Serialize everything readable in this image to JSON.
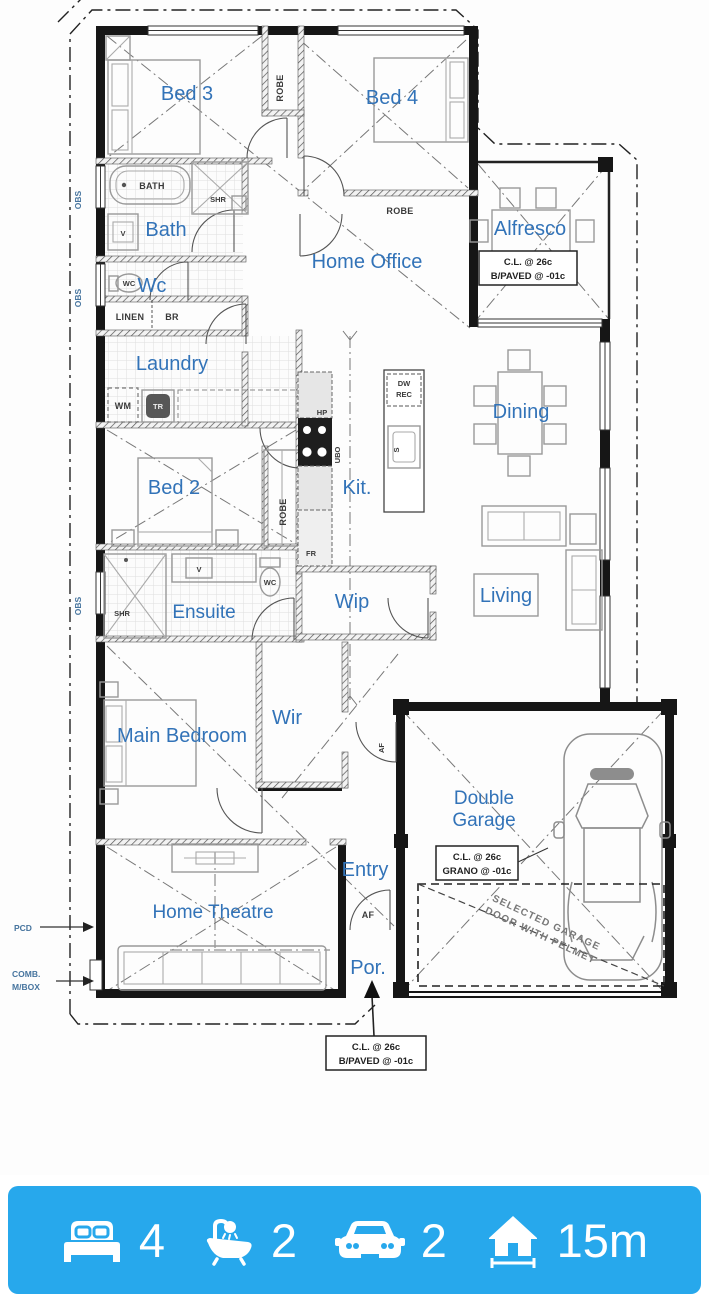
{
  "plan": {
    "rooms": {
      "bed3": "Bed 3",
      "bed4": "Bed 4",
      "bath": "Bath",
      "wc": "Wc",
      "laundry": "Laundry",
      "home_office": "Home Office",
      "alfresco": "Alfresco",
      "dining": "Dining",
      "kitchen": "Kit.",
      "living": "Living",
      "bed2": "Bed 2",
      "ensuite": "Ensuite",
      "wip": "Wip",
      "main_bedroom": "Main Bedroom",
      "wir": "Wir",
      "entry": "Entry",
      "home_theatre": "Home Theatre",
      "porch": "Por.",
      "garage_line1": "Double",
      "garage_line2": "Garage"
    },
    "fixtures": {
      "robe": "ROBE",
      "bath_tub": "BATH",
      "shower": "SHR",
      "vanity": "V",
      "toilet": "WC",
      "linen": "LINEN",
      "broom": "BR",
      "washing_machine": "WM",
      "trough": "TR",
      "hotplate": "HP",
      "under_bench_oven": "UBO",
      "fridge": "FR",
      "dishwasher": "DW",
      "recess": "REC",
      "sink": "S",
      "af": "AF",
      "obscure_glass": "OBS"
    },
    "annotations": {
      "pcd": "PCD",
      "mbox_line1": "COMB.",
      "mbox_line2": "M/BOX",
      "alfresco_note_line1": "C.L. @ 26c",
      "alfresco_note_line2": "B/PAVED @ -01c",
      "garage_note_line1": "C.L. @ 26c",
      "garage_note_line2": "GRANO @ -01c",
      "porch_note_line1": "C.L. @ 26c",
      "porch_note_line2": "B/PAVED @ -01c",
      "garage_door_note_line1": "SELECTED GARAGE",
      "garage_door_note_line2": "DOOR WITH PELMET"
    },
    "label_color": "#3273b8"
  },
  "summary": {
    "bar_color": "#27a8ec",
    "items": [
      {
        "icon": "bed-icon",
        "value": "4"
      },
      {
        "icon": "bath-icon",
        "value": "2"
      },
      {
        "icon": "car-icon",
        "value": "2"
      },
      {
        "icon": "home-icon",
        "value": "15m"
      }
    ]
  }
}
